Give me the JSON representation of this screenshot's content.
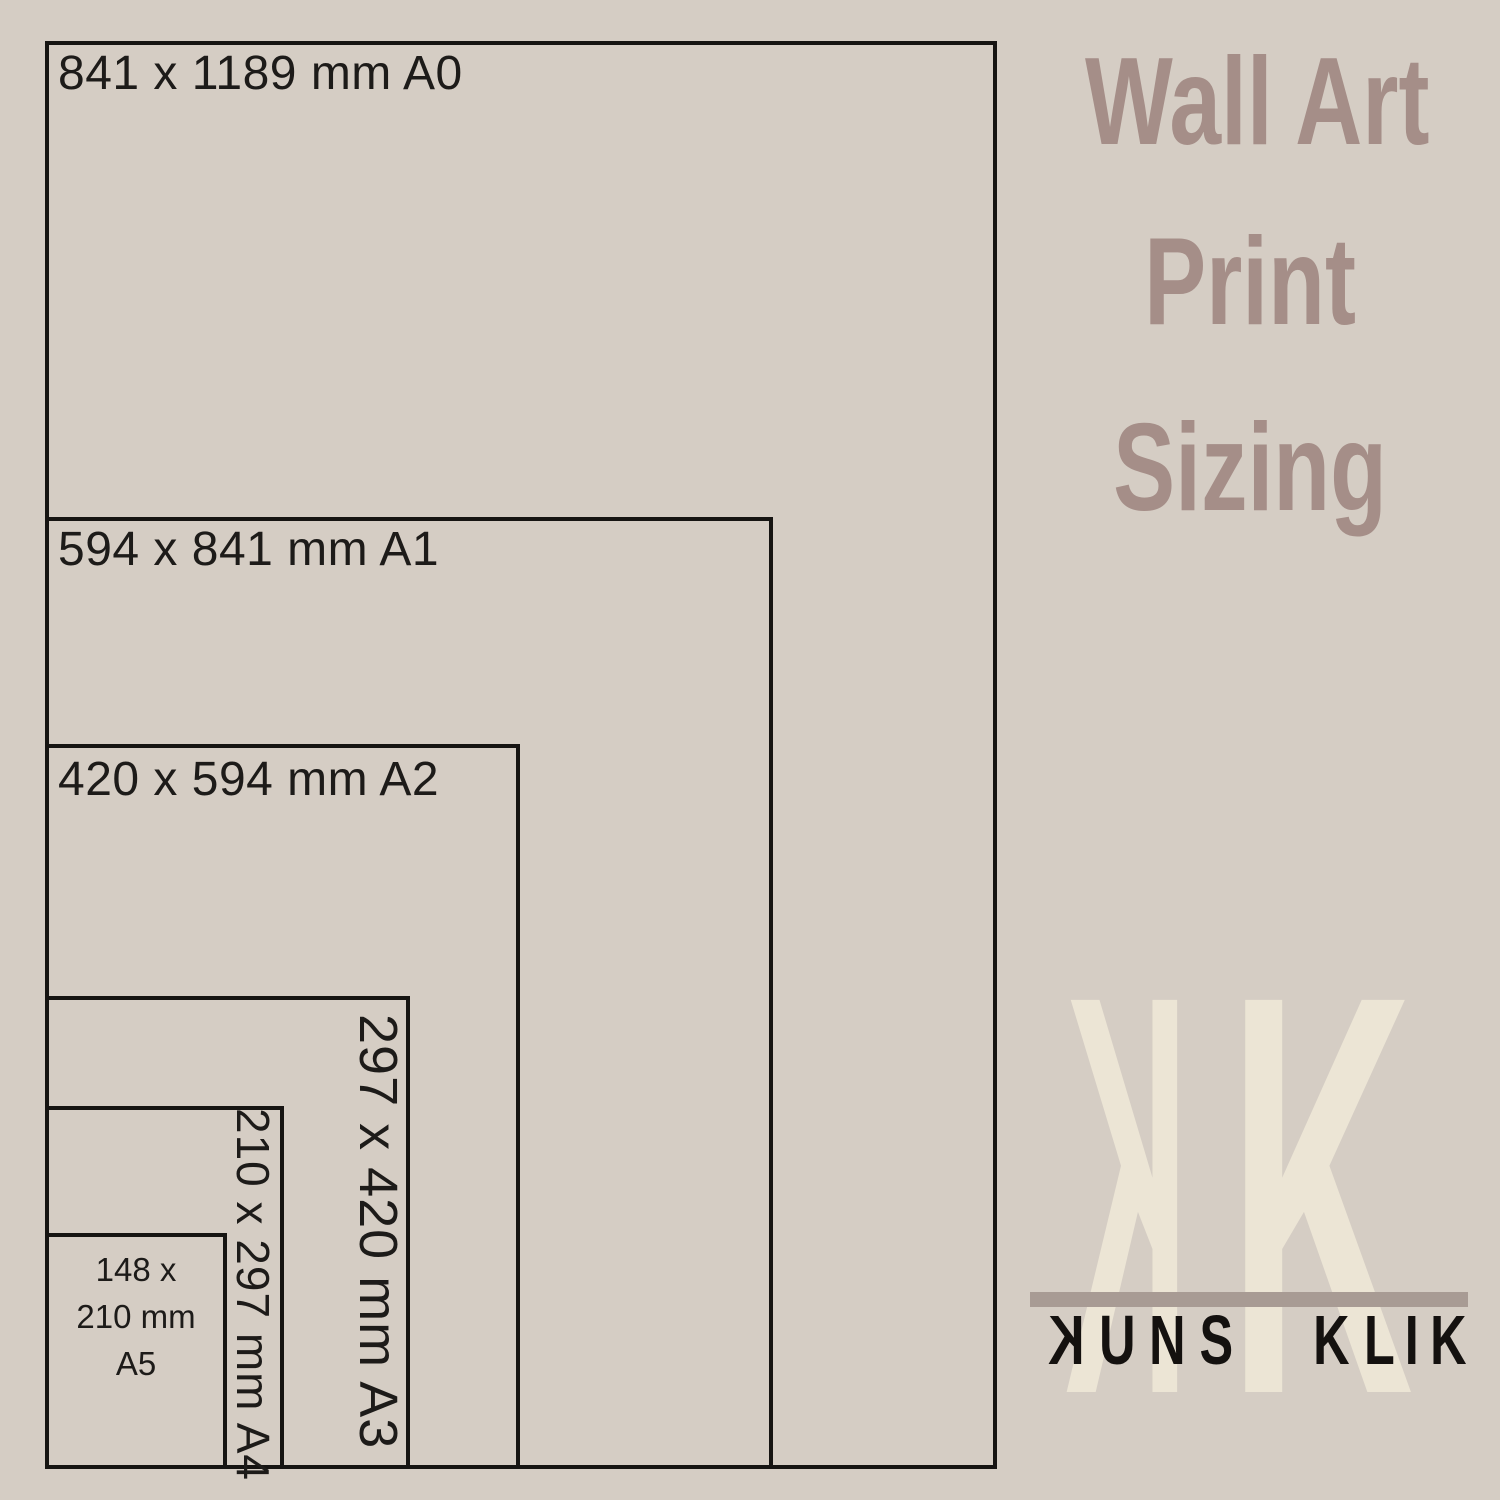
{
  "page": {
    "background_color": "#d5cdc4",
    "line_color": "#161412",
    "label_color": "#1d1b19"
  },
  "title": {
    "line1": "Wall Art",
    "line2": "Print",
    "line3": "Sizing",
    "color": "#a58e88"
  },
  "diagram": {
    "description_sizes": [
      {
        "code": "A0",
        "label": "841 x 1189 mm A0",
        "orientation": "horizontal"
      },
      {
        "code": "A1",
        "label": "594 x 841 mm A1",
        "orientation": "horizontal"
      },
      {
        "code": "A2",
        "label": "420 x 594 mm A2",
        "orientation": "horizontal"
      },
      {
        "code": "A3",
        "label": "297 x 420 mm A3",
        "orientation": "vertical"
      },
      {
        "code": "A4",
        "label": "210 x 297 mm A4",
        "orientation": "vertical"
      },
      {
        "code": "A5",
        "label": "148 x 210 mm A5",
        "orientation": "stacked"
      }
    ],
    "labels": {
      "a0": "841 x 1189 mm A0",
      "a1": "594 x 841 mm A1",
      "a2": "420 x 594 mm A2",
      "a3": "297 x 420 mm A3",
      "a4": "210 x 297 mm A4",
      "a5_lines": [
        "148 x",
        "210 mm",
        "A5"
      ]
    }
  },
  "logo": {
    "monogram_left": "K",
    "monogram_right": "K",
    "monogram_color": "#ece5d5",
    "bar_color": "#a89b94",
    "wordmark": "KUNS KLIK",
    "wordmark_color": "#14110f",
    "word1": [
      "K",
      "U",
      "N",
      "S"
    ],
    "word2": [
      "K",
      "L",
      "I",
      "K"
    ]
  }
}
